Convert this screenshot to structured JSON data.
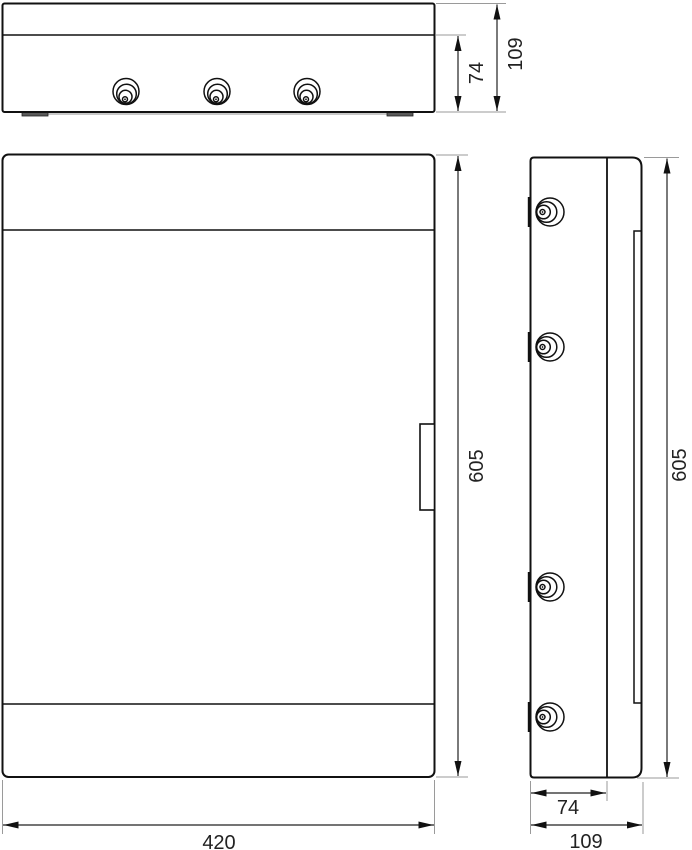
{
  "drawing": {
    "dims": {
      "top_depth_body": "74",
      "top_depth_total": "109",
      "front_height": "605",
      "front_width": "420",
      "side_height": "605",
      "side_depth_body": "74",
      "side_depth_total": "109"
    },
    "colors": {
      "outline": "#111111",
      "dimension_line": "#222222",
      "extension_line": "#9a9a9a",
      "label": "#222222",
      "background": "#ffffff"
    },
    "icons": {
      "gland": "cable-gland-knockout-icon",
      "hinge": "hinge-pin-icon"
    }
  }
}
